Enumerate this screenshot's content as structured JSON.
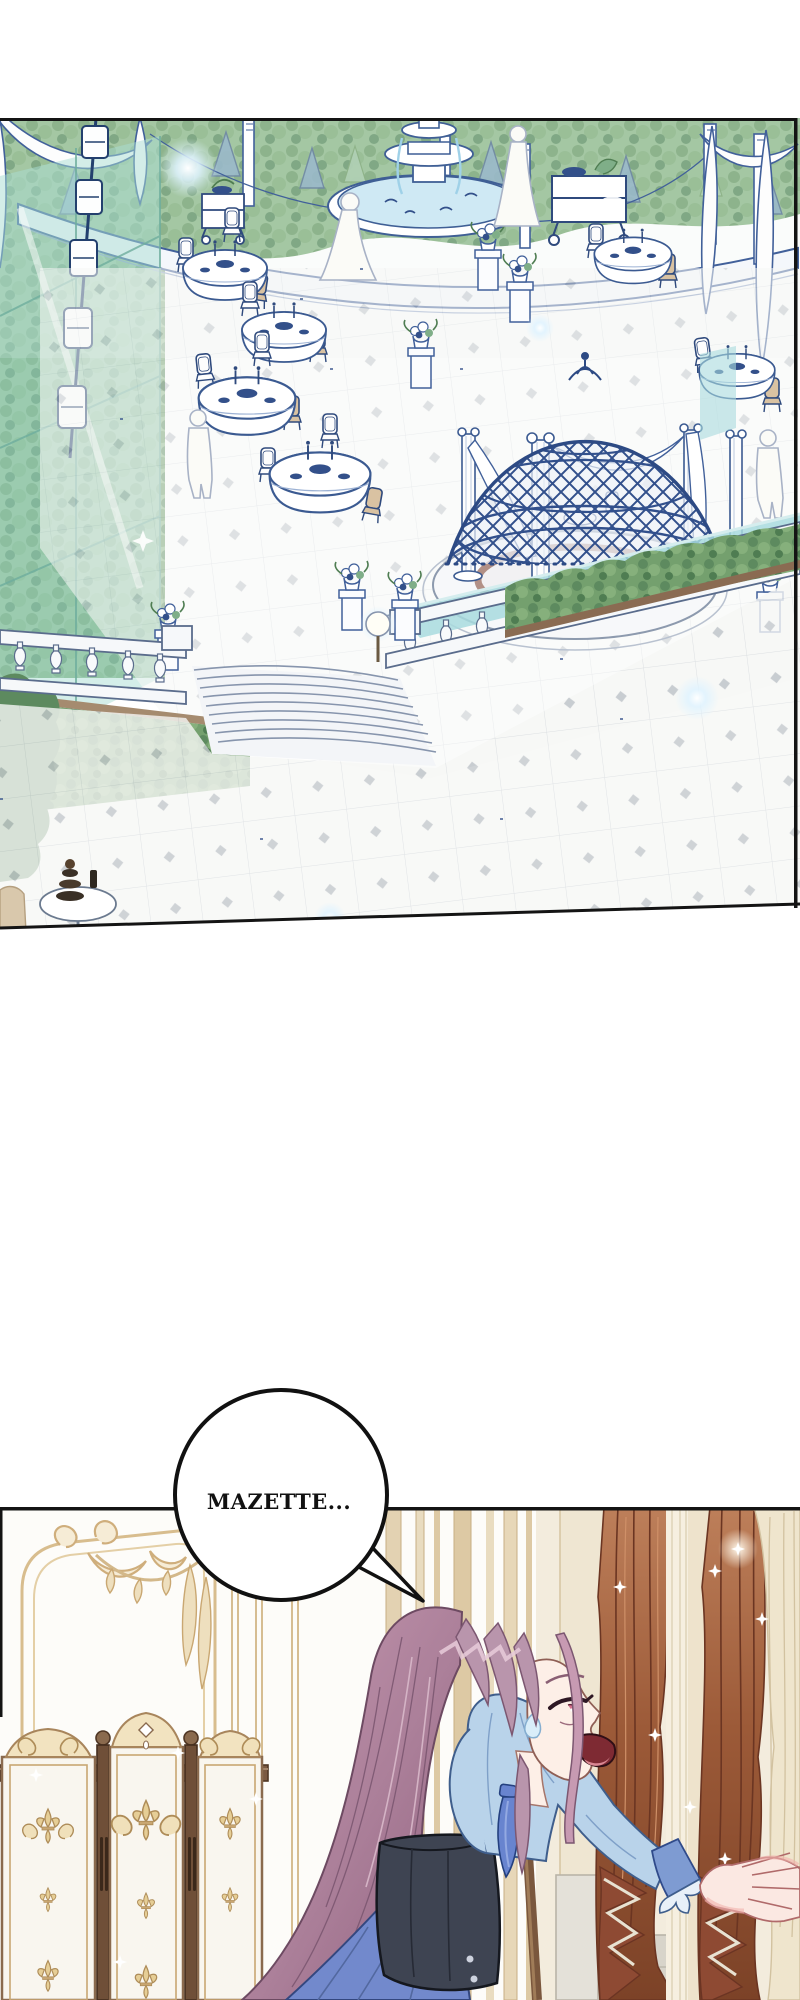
{
  "page": {
    "width": 800,
    "height": 2000,
    "background": "#ffffff"
  },
  "speech_bubble": {
    "text": "MAZETTE..."
  },
  "panels": {
    "garden": {
      "label": "palace garden terrace with banquet tables, fountain, geodesic gazebo, balustrade and stairs",
      "colors": {
        "line": "#32508c",
        "foliage": "#7fae7a",
        "glass": "#a9ddd3",
        "water": "#a8dade",
        "dais_ring": "#b29086",
        "chair_beige": "#d9c2a2",
        "tile_accent": "#c3c8d2"
      }
    },
    "interior": {
      "label": "salon interior with folding screen, reaching heroine and rust curtains",
      "colors": {
        "molding_gold": "#d3b88a",
        "screen_wood": "#7b5a42",
        "fleur_gold": "#e6ce96",
        "curtain_rust": "#9c5a38",
        "sheer": "#efe5cd",
        "hair": "#b08ca3",
        "blouse": "#b9d3ea",
        "skirt": "#7289cc",
        "corset": "#3e4452"
      }
    }
  }
}
